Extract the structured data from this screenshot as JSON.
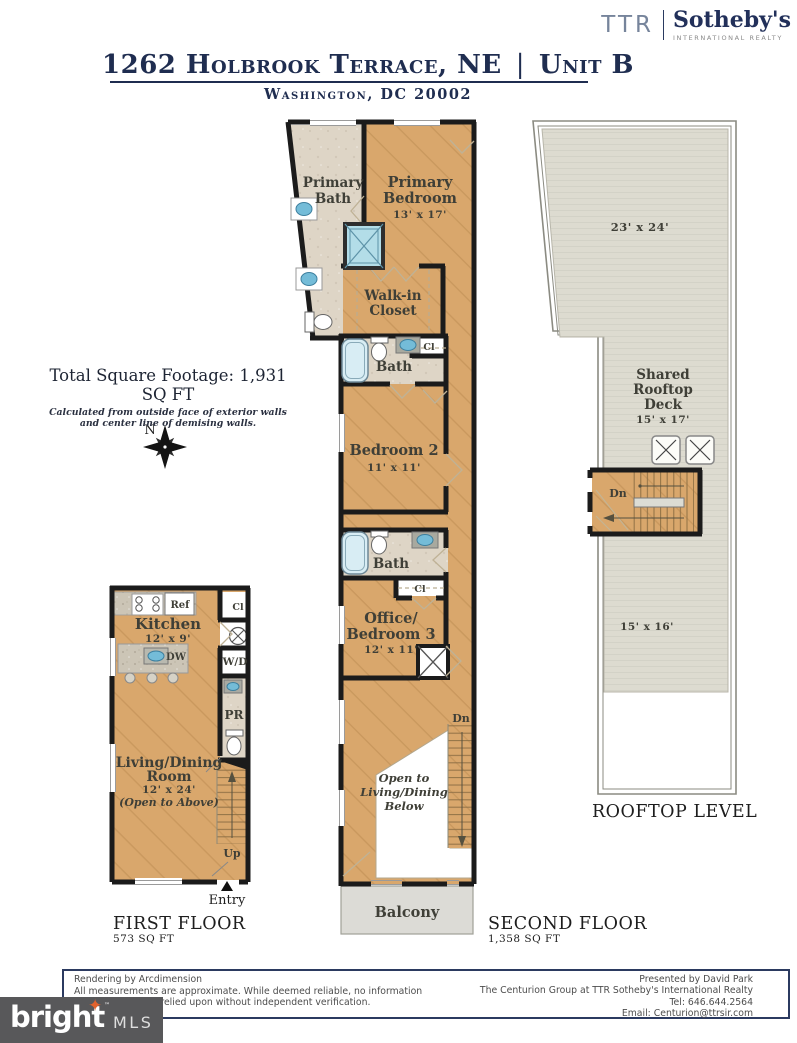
{
  "brand": {
    "ttr": "TTR",
    "name": "Sotheby's",
    "tagline": "INTERNATIONAL REALTY"
  },
  "header": {
    "address": "1262 Holbrook Terrace, NE",
    "separator": "|",
    "unit": "Unit B",
    "city": "Washington, DC 20002"
  },
  "summary": {
    "total": "Total Square Footage: 1,931 SQ FT",
    "note1": "Calculated from outside face of exterior walls",
    "note2": "and center line of demising walls.",
    "compass": "N"
  },
  "second_floor": {
    "primary_bath1": "Primary",
    "primary_bath2": "Bath",
    "primary_bedroom1": "Primary",
    "primary_bedroom2": "Bedroom",
    "primary_bedroom_dim": "13' x 17'",
    "walk_in1": "Walk-in",
    "walk_in2": "Closet",
    "bath_upper": "Bath",
    "cl_upper": "Cl",
    "bedroom2": "Bedroom 2",
    "bedroom2_dim": "11' x 11'",
    "bath_lower": "Bath",
    "cl_lower": "Cl",
    "office1": "Office/",
    "office2": "Bedroom 3",
    "office_dim": "12' x 11'",
    "open1": "Open to",
    "open2": "Living/Dining",
    "open3": "Below",
    "dn": "Dn",
    "balcony": "Balcony",
    "label": "SECOND FLOOR",
    "area": "1,358 SQ FT"
  },
  "first_floor": {
    "kitchen": "Kitchen",
    "kitchen_dim": "12' x 9'",
    "ref": "Ref",
    "cl": "Cl",
    "dw": "DW",
    "wd": "W/D",
    "pr": "PR",
    "living1": "Living/Dining",
    "living2": "Room",
    "living_dim": "12' x 24'",
    "living_note": "(Open to Above)",
    "up": "Up",
    "entry": "Entry",
    "label": "FIRST FLOOR",
    "area": "573 SQ FT"
  },
  "rooftop": {
    "upper_dim": "23' x 24'",
    "deck1": "Shared",
    "deck2": "Rooftop",
    "deck3": "Deck",
    "deck_dim": "15' x 17'",
    "dn": "Dn",
    "lower_dim": "15' x 16'",
    "label": "ROOFTOP LEVEL"
  },
  "footer": {
    "rendering": "Rendering by Arcdimension",
    "disclaimer1": "All measurements are approximate. While deemed reliable, no information",
    "disclaimer2": "should be relied upon without independent verification.",
    "presented": "Presented by David Park",
    "company": "The Centurion Group at TTR Sotheby's International Realty",
    "tel": "Tel: 646.644.2564",
    "email": "Email: Centurion@ttrsir.com"
  },
  "mls": {
    "bright": "bright",
    "mls": "MLS"
  },
  "colors": {
    "navy": "#1f2d50",
    "wood": "#d9a76c",
    "tile": "#ded5c6",
    "deck": "#dddbd0",
    "balcony": "#dcdbd6",
    "fixture_blue": "#74bcd8",
    "wall": "#1b1b1b",
    "label": "#3f3f37",
    "mls_bg": "#58585a",
    "mls_star": "#e0622d"
  }
}
